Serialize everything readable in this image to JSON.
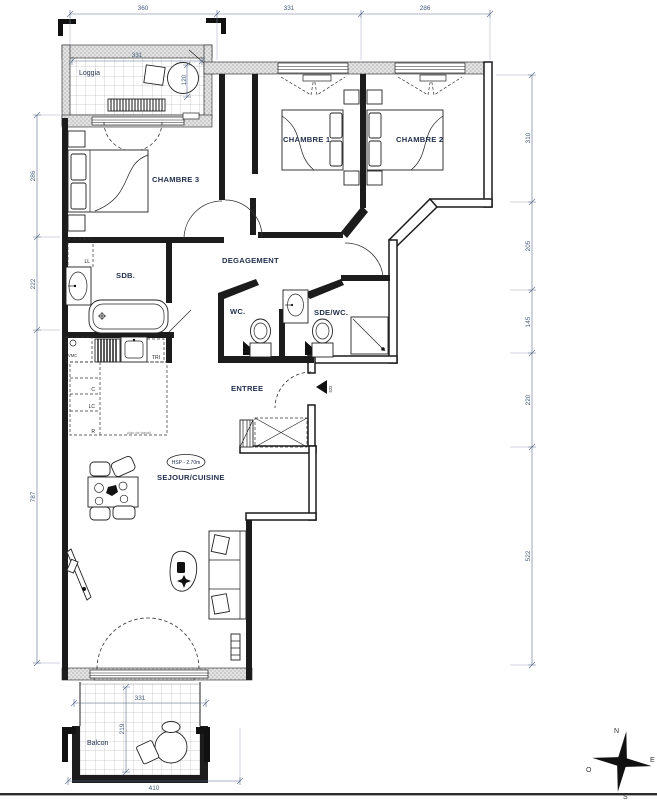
{
  "plan_title": "Plan d'appartement 3 chambres avec loggia et balcon",
  "rooms": {
    "loggia": "Loggia",
    "chambre1": "CHAMBRE 1",
    "chambre2": "CHAMBRE 2",
    "chambre3": "CHAMBRE 3",
    "sdb": "SDB.",
    "degagement": "DEGAGEMENT",
    "wc": "WC.",
    "sde_wc": "SDE/WC.",
    "entree": "ENTREE",
    "sejour_cuisine": "SEJOUR/CUISINE",
    "balcon": "Balcon"
  },
  "annotations": {
    "ll": "LL",
    "vmc": "VMC",
    "tri": "TRI",
    "c": "C",
    "lc": "LC",
    "r": "R",
    "hsp": "HSP - 2.70m",
    "kitchen_note": "plan de travail",
    "entry_tag": "522"
  },
  "dimensions": {
    "top": [
      "360",
      "331",
      "286"
    ],
    "left": [
      "286",
      "222",
      "787"
    ],
    "right": [
      "310",
      "205",
      "145",
      "220",
      "522"
    ],
    "loggia": {
      "width": "331",
      "depth": "120"
    },
    "balcony": {
      "width": "331",
      "depth": "219",
      "total": "410"
    }
  },
  "compass": {
    "north": "N",
    "east": "E",
    "south": "S",
    "west": "O"
  }
}
